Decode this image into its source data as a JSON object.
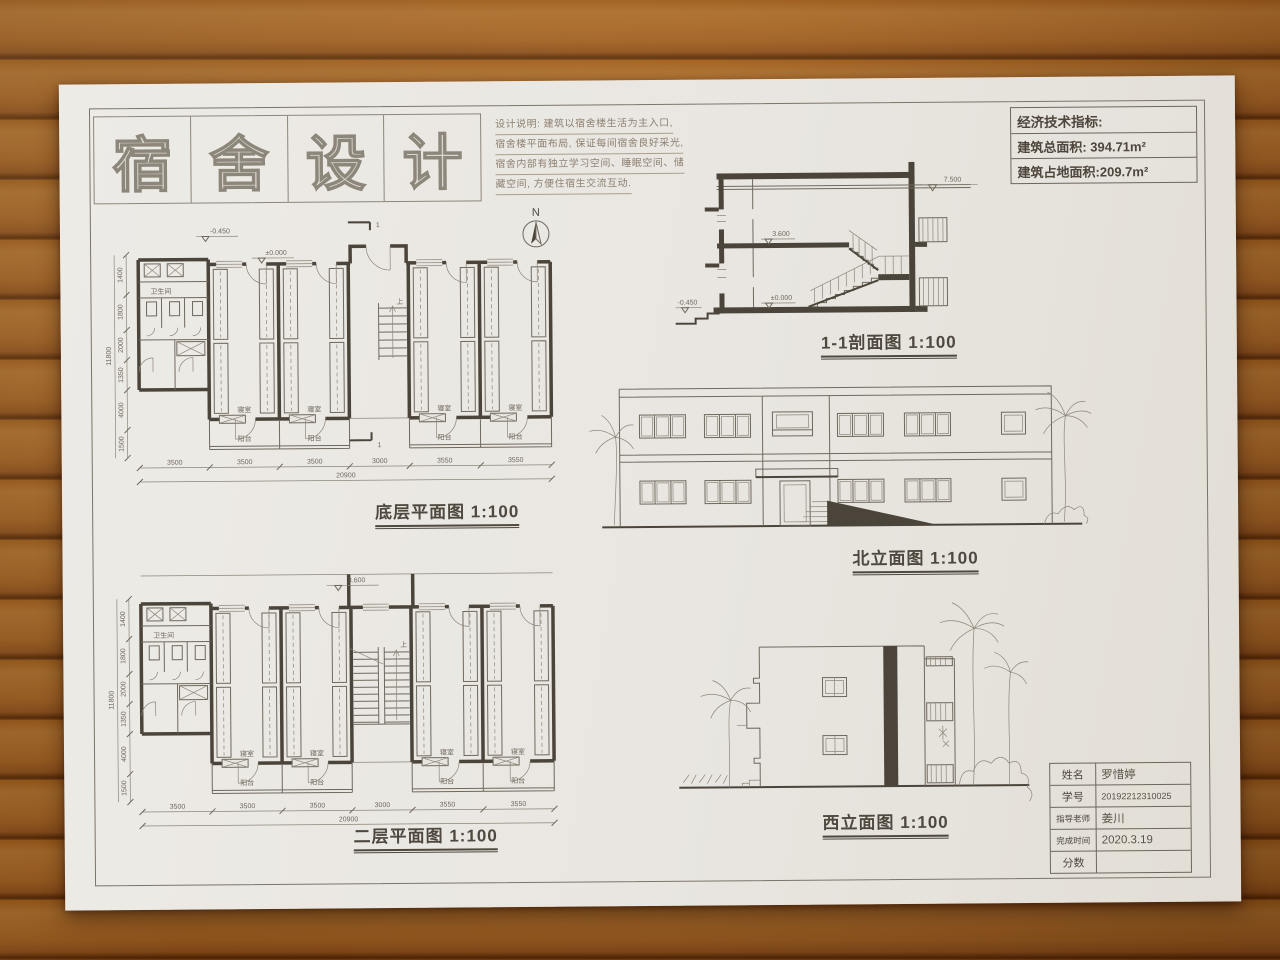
{
  "poster": {
    "title_chars": [
      "宿",
      "舍",
      "设",
      "计"
    ],
    "compass_letter": "N"
  },
  "notes": {
    "lines": [
      "设计说明: 建筑以宿舍楼生活为主入口,",
      "宿舍楼平面布局, 保证每间宿舍良好采光,",
      "宿舍内部有独立学习空间、睡眠空间、储",
      "藏空间, 方便住宿生交流互动."
    ]
  },
  "indicators": {
    "heading": "经济技术指标:",
    "total_area": "建筑总面积: 394.71m²",
    "footprint_area": "建筑占地面积:209.7m²"
  },
  "labels": {
    "section": "1-1剖面图 1:100",
    "north_elevation": "北立面图 1:100",
    "west_elevation": "西立面图 1:100",
    "plan_ground": "底层平面图 1:100",
    "plan_second": "二层平面图 1:100"
  },
  "levels": {
    "roof": "7.500",
    "second": "3.600",
    "ground": "±0.000",
    "site": "-0.450"
  },
  "rooms": {
    "bedroom": "寝室",
    "balcony": "阳台",
    "toilet": "卫生间"
  },
  "dims": {
    "bottom": [
      "3500",
      "3500",
      "3500",
      "3000",
      "3550",
      "3550"
    ],
    "bottom_total": "20900",
    "left": [
      "1400",
      "1800",
      "2000",
      "1350",
      "4000",
      "1500"
    ],
    "left_total": "11800"
  },
  "marks": {
    "cut": "1",
    "up": "上"
  },
  "titleblock": {
    "rows": [
      {
        "label": "姓名",
        "value": "罗惜婷"
      },
      {
        "label": "学号",
        "value": "20192212310025"
      },
      {
        "label": "指导老师",
        "value": "姜川"
      },
      {
        "label": "完成时间",
        "value": "2020.3.19"
      },
      {
        "label": "分数",
        "value": ""
      }
    ]
  }
}
